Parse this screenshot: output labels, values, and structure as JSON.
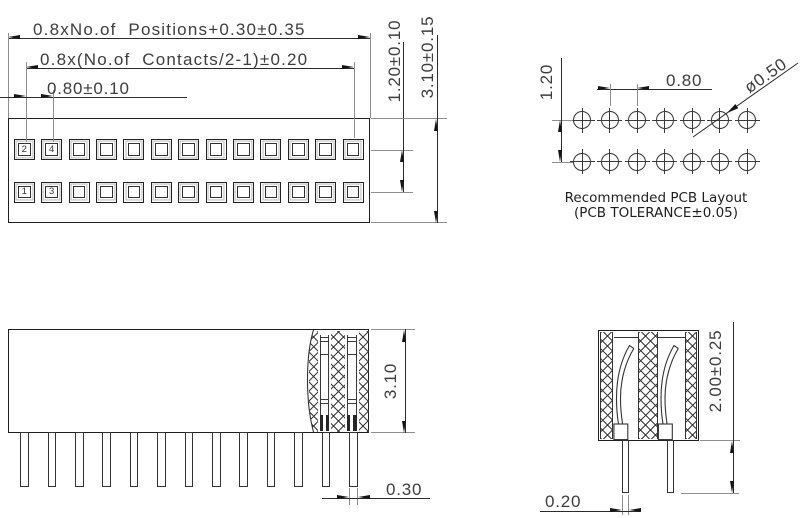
{
  "top_view": {
    "dim_overall_label": "0.8xNo.of  Positions+0.30±0.35",
    "dim_contacts_label": "0.8x(No.of  Contacts/2-1)±0.20",
    "dim_pitch_label": "0.80±0.10",
    "dim_row_spacing_label": "1.20±0.10",
    "dim_height_label": "3.10±0.15",
    "positions": 13,
    "rows": [
      {
        "labels": [
          "2",
          "4"
        ]
      },
      {
        "labels": [
          "1",
          "3"
        ]
      }
    ]
  },
  "pcb_layout": {
    "dim_row_spacing_label": "1.20",
    "dim_pitch_label": "0.80",
    "dim_hole_dia_label": "ø0.50",
    "holes_per_row": 7,
    "caption_line1": "Recommended PCB Layout",
    "caption_line2": "(PCB TOLERANCE±0.05)"
  },
  "side_view": {
    "dim_height_label": "3.10",
    "dim_pin_width_label": "0.30",
    "pin_count": 13
  },
  "section_view": {
    "dim_tail_length_label": "2.00±0.25",
    "dim_pin_thickness_label": "0.20"
  },
  "colors": {
    "line": "#1f1f1f",
    "dim": "#2b2b2b",
    "ext": "#8f8f8f",
    "text": "#3d3d3d",
    "hatch": "#3a3a3a",
    "bg": "#ffffff"
  }
}
